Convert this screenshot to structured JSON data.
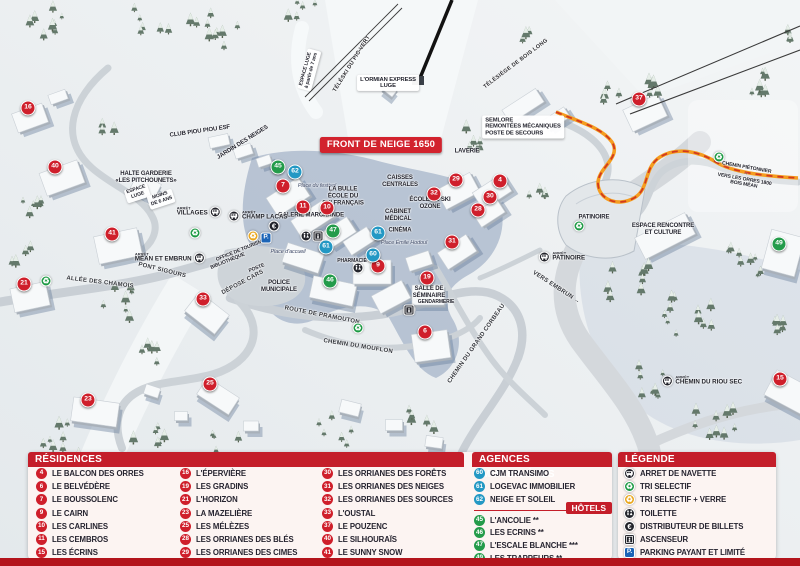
{
  "colors": {
    "residence": "#cf1f2b",
    "agence": "#2398c4",
    "hotel": "#239b4a",
    "header_red": "#c41e2a",
    "bottom_strip": "#b3141c",
    "banner_red": "#d2232e",
    "path_orange": "#f59d1f"
  },
  "map": {
    "banner": "FRONT DE NEIGE 1650",
    "bus_stop_prefix": "ARRÊT",
    "markers": [
      {
        "num": "4",
        "type": "residence",
        "x": 500,
        "y": 181
      },
      {
        "num": "6",
        "type": "residence",
        "x": 425,
        "y": 332
      },
      {
        "num": "7",
        "type": "residence",
        "x": 283,
        "y": 186
      },
      {
        "num": "9",
        "type": "residence",
        "x": 378,
        "y": 266
      },
      {
        "num": "10",
        "type": "residence",
        "x": 327,
        "y": 208
      },
      {
        "num": "11",
        "type": "residence",
        "x": 303,
        "y": 207
      },
      {
        "num": "15",
        "type": "residence",
        "x": 780,
        "y": 379
      },
      {
        "num": "16",
        "type": "residence",
        "x": 28,
        "y": 108
      },
      {
        "num": "19",
        "type": "residence",
        "x": 427,
        "y": 278
      },
      {
        "num": "21",
        "type": "residence",
        "x": 24,
        "y": 284
      },
      {
        "num": "23",
        "type": "residence",
        "x": 88,
        "y": 400
      },
      {
        "num": "25",
        "type": "residence",
        "x": 210,
        "y": 384
      },
      {
        "num": "28",
        "type": "residence",
        "x": 478,
        "y": 210
      },
      {
        "num": "29",
        "type": "residence",
        "x": 456,
        "y": 180
      },
      {
        "num": "30",
        "type": "residence",
        "x": 490,
        "y": 197
      },
      {
        "num": "31",
        "type": "residence",
        "x": 452,
        "y": 242
      },
      {
        "num": "32",
        "type": "residence",
        "x": 434,
        "y": 194
      },
      {
        "num": "33",
        "type": "residence",
        "x": 203,
        "y": 299
      },
      {
        "num": "37",
        "type": "residence",
        "x": 639,
        "y": 99
      },
      {
        "num": "40",
        "type": "residence",
        "x": 55,
        "y": 167
      },
      {
        "num": "41",
        "type": "residence",
        "x": 112,
        "y": 234
      },
      {
        "num": "60",
        "type": "agence",
        "x": 373,
        "y": 255
      },
      {
        "num": "61",
        "type": "agence",
        "x": 326,
        "y": 247
      },
      {
        "num": "61",
        "type": "agence",
        "x": 378,
        "y": 233
      },
      {
        "num": "62",
        "type": "agence",
        "x": 295,
        "y": 172
      },
      {
        "num": "45",
        "type": "hotel",
        "x": 278,
        "y": 167
      },
      {
        "num": "46",
        "type": "hotel",
        "x": 330,
        "y": 281
      },
      {
        "num": "47",
        "type": "hotel",
        "x": 333,
        "y": 231
      },
      {
        "num": "49",
        "type": "hotel",
        "x": 779,
        "y": 244
      }
    ],
    "services": [
      {
        "icon": "recycle-green",
        "x": 195,
        "y": 233
      },
      {
        "icon": "recycle-green",
        "x": 46,
        "y": 281
      },
      {
        "icon": "recycle-green",
        "x": 358,
        "y": 328
      },
      {
        "icon": "recycle-green",
        "x": 579,
        "y": 226
      },
      {
        "icon": "recycle-green",
        "x": 719,
        "y": 157
      },
      {
        "icon": "recycle-yellow",
        "x": 253,
        "y": 236
      },
      {
        "icon": "parking",
        "x": 266,
        "y": 238
      },
      {
        "icon": "euro",
        "x": 274,
        "y": 226
      },
      {
        "icon": "wc",
        "x": 306,
        "y": 236
      },
      {
        "icon": "elevator",
        "x": 318,
        "y": 236
      },
      {
        "icon": "wc",
        "x": 358,
        "y": 268
      },
      {
        "icon": "elevator",
        "x": 409,
        "y": 310
      }
    ],
    "bus_stops": [
      {
        "name": "VILLAGES",
        "x": 199,
        "y": 212,
        "side": "right"
      },
      {
        "name": "CHAMP LACAS",
        "x": 258,
        "y": 216,
        "side": "left"
      },
      {
        "name": "MÉAN ET EMBRUN",
        "x": 170,
        "y": 258,
        "side": "right"
      },
      {
        "name": "PATINOIRE",
        "x": 562,
        "y": 257,
        "side": "left"
      },
      {
        "name": "CHEMIN DU RIOU SEC",
        "x": 702,
        "y": 381,
        "side": "left"
      }
    ],
    "labels": [
      {
        "text": "ESPACE LUGE\nà partir de 7 ans",
        "x": 309,
        "y": 70,
        "rot": -75,
        "style": "whitebox-small"
      },
      {
        "text": "TÉLÉSKI DU PIC VERT",
        "x": 352,
        "y": 64,
        "rot": -58,
        "style": "lift"
      },
      {
        "text": "L'ORMIAN EXPRESS\nLUGE",
        "x": 388,
        "y": 83,
        "style": "whitebox"
      },
      {
        "text": "TÉLÉSIÈGE DE BOIS LONG",
        "x": 516,
        "y": 64,
        "rot": -37,
        "style": "lift"
      },
      {
        "text": "SEMLORE\nREMONTÉES MÉCANIQUES\nPOSTE DE SECOURS",
        "x": 523,
        "y": 127,
        "style": "whitebox-left"
      },
      {
        "text": "CLUB PIOU PIOU ESF",
        "x": 200,
        "y": 132,
        "rot": -8,
        "style": "map"
      },
      {
        "text": "JARDIN DES NEIGES",
        "x": 243,
        "y": 143,
        "rot": -32,
        "style": "map"
      },
      {
        "text": "HALTE GARDERIE\n«LES PITCHOUNETS»",
        "x": 146,
        "y": 178,
        "style": "map"
      },
      {
        "text": "ESPACE\nLUGE",
        "x": 137,
        "y": 193,
        "rot": -18,
        "style": "whitebox-small"
      },
      {
        "text": "MOINS\nDE 6 ANS",
        "x": 161,
        "y": 199,
        "rot": -18,
        "style": "whitebox-small"
      },
      {
        "text": "ALLÉE DES CHAMOIS",
        "x": 100,
        "y": 283,
        "rot": 7,
        "style": "road"
      },
      {
        "text": "PONT SIGOURS",
        "x": 162,
        "y": 271,
        "rot": 14,
        "style": "road"
      },
      {
        "text": "ROUTE DE PRAMOUTON",
        "x": 322,
        "y": 316,
        "rot": 11,
        "style": "road"
      },
      {
        "text": "CHEMIN DU MOUFLON",
        "x": 358,
        "y": 347,
        "rot": 9,
        "style": "road"
      },
      {
        "text": "CHEMIN DU GRAND CORBEAU",
        "x": 477,
        "y": 344,
        "rot": -55,
        "style": "road"
      },
      {
        "text": "VERS EMBRUN →",
        "x": 556,
        "y": 288,
        "rot": 33,
        "style": "road"
      },
      {
        "text": "DÉPOSE CARS",
        "x": 243,
        "y": 283,
        "rot": -28,
        "style": "road"
      },
      {
        "text": "OFFICE DE TOURISME",
        "x": 241,
        "y": 251,
        "rot": -22,
        "style": "tiny"
      },
      {
        "text": "BIBLIOTHÈQUE",
        "x": 228,
        "y": 262,
        "rot": -22,
        "style": "tiny"
      },
      {
        "text": "POSTE",
        "x": 257,
        "y": 269,
        "rot": -22,
        "style": "tiny"
      },
      {
        "text": "POLICE\nMUNICIPALE",
        "x": 279,
        "y": 287,
        "style": "map"
      },
      {
        "text": "Place du festival",
        "x": 317,
        "y": 186,
        "style": "place"
      },
      {
        "text": "Place d'accueil",
        "x": 288,
        "y": 252,
        "style": "place"
      },
      {
        "text": "Place Émile Hodoul",
        "x": 404,
        "y": 243,
        "style": "place"
      },
      {
        "text": "GALERIE MARCHANDE",
        "x": 311,
        "y": 216,
        "style": "map"
      },
      {
        "text": "LA BULLE\nÉCOLE DU\nSKI FRANÇAIS",
        "x": 343,
        "y": 197,
        "style": "map"
      },
      {
        "text": "CAISSES\nCENTRALES",
        "x": 400,
        "y": 182,
        "style": "map"
      },
      {
        "text": "CABINET\nMÉDICAL",
        "x": 398,
        "y": 216,
        "style": "map"
      },
      {
        "text": "CINÉMA",
        "x": 400,
        "y": 231,
        "style": "map"
      },
      {
        "text": "PHARMACIE",
        "x": 352,
        "y": 262,
        "style": "tiny"
      },
      {
        "text": "ÉCOLE DE SKI\nOZONE",
        "x": 430,
        "y": 204,
        "style": "map"
      },
      {
        "text": "LAVERIE",
        "x": 467,
        "y": 152,
        "style": "map"
      },
      {
        "text": "SALLE DE\nSÉMINAIRE",
        "x": 429,
        "y": 293,
        "style": "map"
      },
      {
        "text": "GENDARMERIE",
        "x": 436,
        "y": 303,
        "style": "tiny"
      },
      {
        "text": "PATINOIRE",
        "x": 594,
        "y": 218,
        "style": "map"
      },
      {
        "text": "ESPACE RENCONTRE\nET CULTURE",
        "x": 663,
        "y": 230,
        "style": "map"
      },
      {
        "text": "CHEMIN PIÉTONNIER →\nVERS LES ORRES 1800\nBOIS MÉAN",
        "x": 745,
        "y": 177,
        "rot": 10,
        "style": "tiny"
      },
      {
        "text": "FRONT DE NEIGE 1650",
        "x": 381,
        "y": 145,
        "style": "banner"
      }
    ]
  },
  "legend": {
    "residences": {
      "title": "RÉSIDENCES",
      "items": [
        {
          "num": "4",
          "name": "LE BALCON DES ORRES"
        },
        {
          "num": "6",
          "name": "LE BELVÉDÈRE"
        },
        {
          "num": "7",
          "name": "LE BOUSSOLENC"
        },
        {
          "num": "9",
          "name": "LE CAIRN"
        },
        {
          "num": "10",
          "name": "LES CARLINES"
        },
        {
          "num": "11",
          "name": "LES CEMBROS"
        },
        {
          "num": "15",
          "name": "LES ÉCRINS"
        },
        {
          "num": "16",
          "name": "L'ÉPERVIÈRE"
        },
        {
          "num": "19",
          "name": "LES GRADINS"
        },
        {
          "num": "21",
          "name": "L'HORIZON"
        },
        {
          "num": "23",
          "name": "LA MAZELIÈRE"
        },
        {
          "num": "25",
          "name": "LES MÉLÈZES"
        },
        {
          "num": "28",
          "name": "LES ORRIANES DES BLÉS"
        },
        {
          "num": "29",
          "name": "LES ORRIANES DES CIMES"
        },
        {
          "num": "30",
          "name": "LES ORRIANES DES FORÊTS"
        },
        {
          "num": "31",
          "name": "LES ORRIANES DES NEIGES"
        },
        {
          "num": "32",
          "name": "LES ORRIANES DES SOURCES"
        },
        {
          "num": "33",
          "name": "L'OUSTAL"
        },
        {
          "num": "37",
          "name": "LE POUZENC"
        },
        {
          "num": "40",
          "name": "LE SILHOURAÏS"
        },
        {
          "num": "41",
          "name": "LE SUNNY SNOW"
        }
      ]
    },
    "agences": {
      "title": "AGENCES IMMOBILIÈRES",
      "items": [
        {
          "num": "60",
          "name": "CJM TRANSIMO"
        },
        {
          "num": "61",
          "name": "LOGEVAC IMMOBILIER"
        },
        {
          "num": "62",
          "name": "NEIGE ET SOLEIL"
        }
      ]
    },
    "hotels": {
      "title": "HÔTELS",
      "items": [
        {
          "num": "45",
          "name": "L'ANCOLIE **"
        },
        {
          "num": "46",
          "name": "LES ECRINS **"
        },
        {
          "num": "47",
          "name": "L'ESCALE BLANCHE ***"
        },
        {
          "num": "49",
          "name": "LES TRAPPEURS **"
        }
      ]
    },
    "legende": {
      "title": "LÉGENDE",
      "items": [
        {
          "icon": "bus",
          "label": "ARRET DE NAVETTE"
        },
        {
          "icon": "recycle-green",
          "label": "TRI SELECTIF"
        },
        {
          "icon": "recycle-yellow",
          "label": "TRI SELECTIF + VERRE"
        },
        {
          "icon": "wc",
          "label": "TOILETTE"
        },
        {
          "icon": "euro",
          "label": "DISTRIBUTEUR DE BILLETS"
        },
        {
          "icon": "elevator",
          "label": "ASCENSEUR"
        },
        {
          "icon": "parking",
          "label": "PARKING PAYANT ET LIMITÉ"
        }
      ]
    }
  }
}
